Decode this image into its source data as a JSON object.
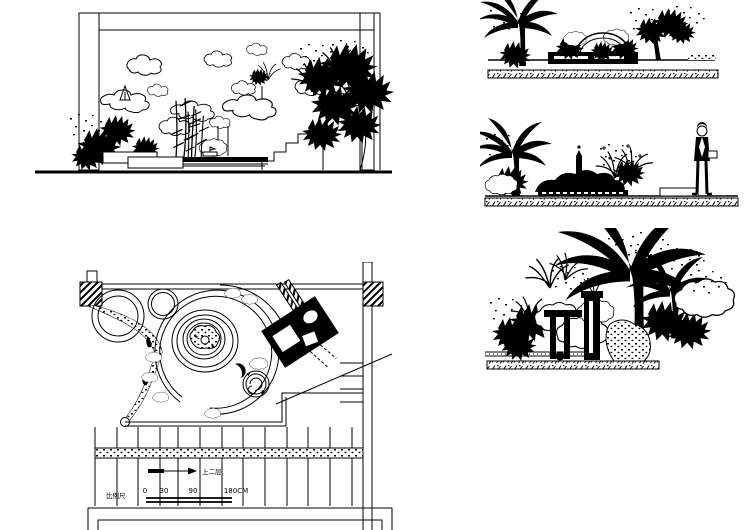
{
  "sheet": {
    "background": "#ffffff",
    "line_color": "#000000",
    "width": 749,
    "height": 530
  },
  "plan": {
    "scale_label": "比例尺",
    "scale_ticks": [
      "0",
      "30",
      "90",
      "180CM"
    ],
    "direction_note": "上二层"
  }
}
